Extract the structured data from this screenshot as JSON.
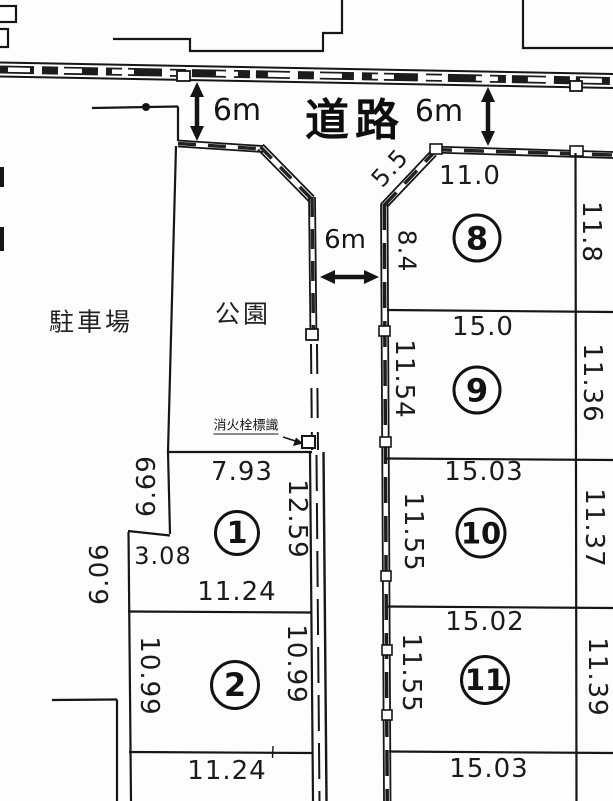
{
  "areas": {
    "road": "道路",
    "parking": "駐車場",
    "park": "公園",
    "hydrant_sign": "消火栓標識"
  },
  "road_widths": {
    "top_left": "6m",
    "top_right": "6m",
    "north_south": "6m"
  },
  "boundary_dims": {
    "west": "6.06"
  },
  "plots": {
    "p1": {
      "num": "1",
      "top": "7.93",
      "left_upper": "6.69",
      "left_lower": "3.08",
      "right": "12.59",
      "bottom": "11.24"
    },
    "p2": {
      "num": "2",
      "left": "10.99",
      "right": "10.99",
      "bottom": "11.24"
    },
    "p8": {
      "num": "8",
      "chamfer": "5.5",
      "top": "11.0",
      "left": "8.4",
      "right": "11.8"
    },
    "p9": {
      "num": "9",
      "top": "15.0",
      "left": "11.54",
      "right": "11.36"
    },
    "p10": {
      "num": "10",
      "top": "15.03",
      "left": "11.55",
      "right": "11.37"
    },
    "p11": {
      "num": "11",
      "top": "15.02",
      "left": "11.55",
      "right": "11.39",
      "bottom": "15.03"
    }
  }
}
